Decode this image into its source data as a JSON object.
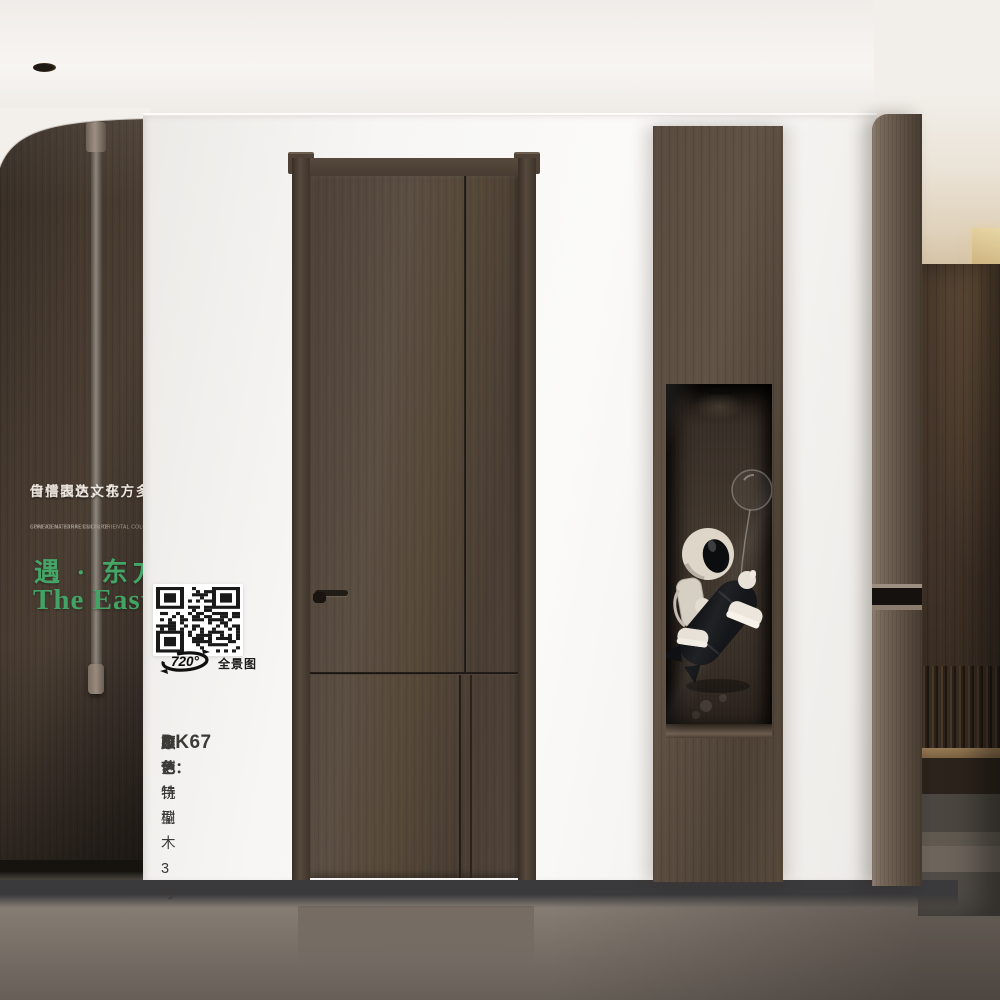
{
  "brand": {
    "slogan_cn_line1": "传播国色文化",
    "slogan_cn_line2": "自信表达，东方多彩！",
    "slogan_en_line1": "SPREAD NATIONAL CULTURE",
    "slogan_en_line2": "CONFIDENT EXPRESSION, ORIENTAL COLORFUL!",
    "title_cn": "遇 · 东方",
    "title_en": "The East",
    "accent_color": "#45a567"
  },
  "panorama": {
    "degrees": "720°",
    "label": "全景图"
  },
  "product": {
    "model": "DK67",
    "color_label": "颜色：",
    "color_value": "布伦特榆木3号",
    "craft_label": "工艺：",
    "craft_value": "雕刻铣型"
  },
  "icons": {
    "qr": "qr-code",
    "panorama_rotation": "panorama-rotation-icon",
    "downlight": "ceiling-downlight"
  },
  "colors": {
    "wood_wall": "#43382e",
    "door_wood": "#55483d",
    "wall_white": "#f6f4f1",
    "floor": "#847b72",
    "accent_green": "#45a567"
  }
}
